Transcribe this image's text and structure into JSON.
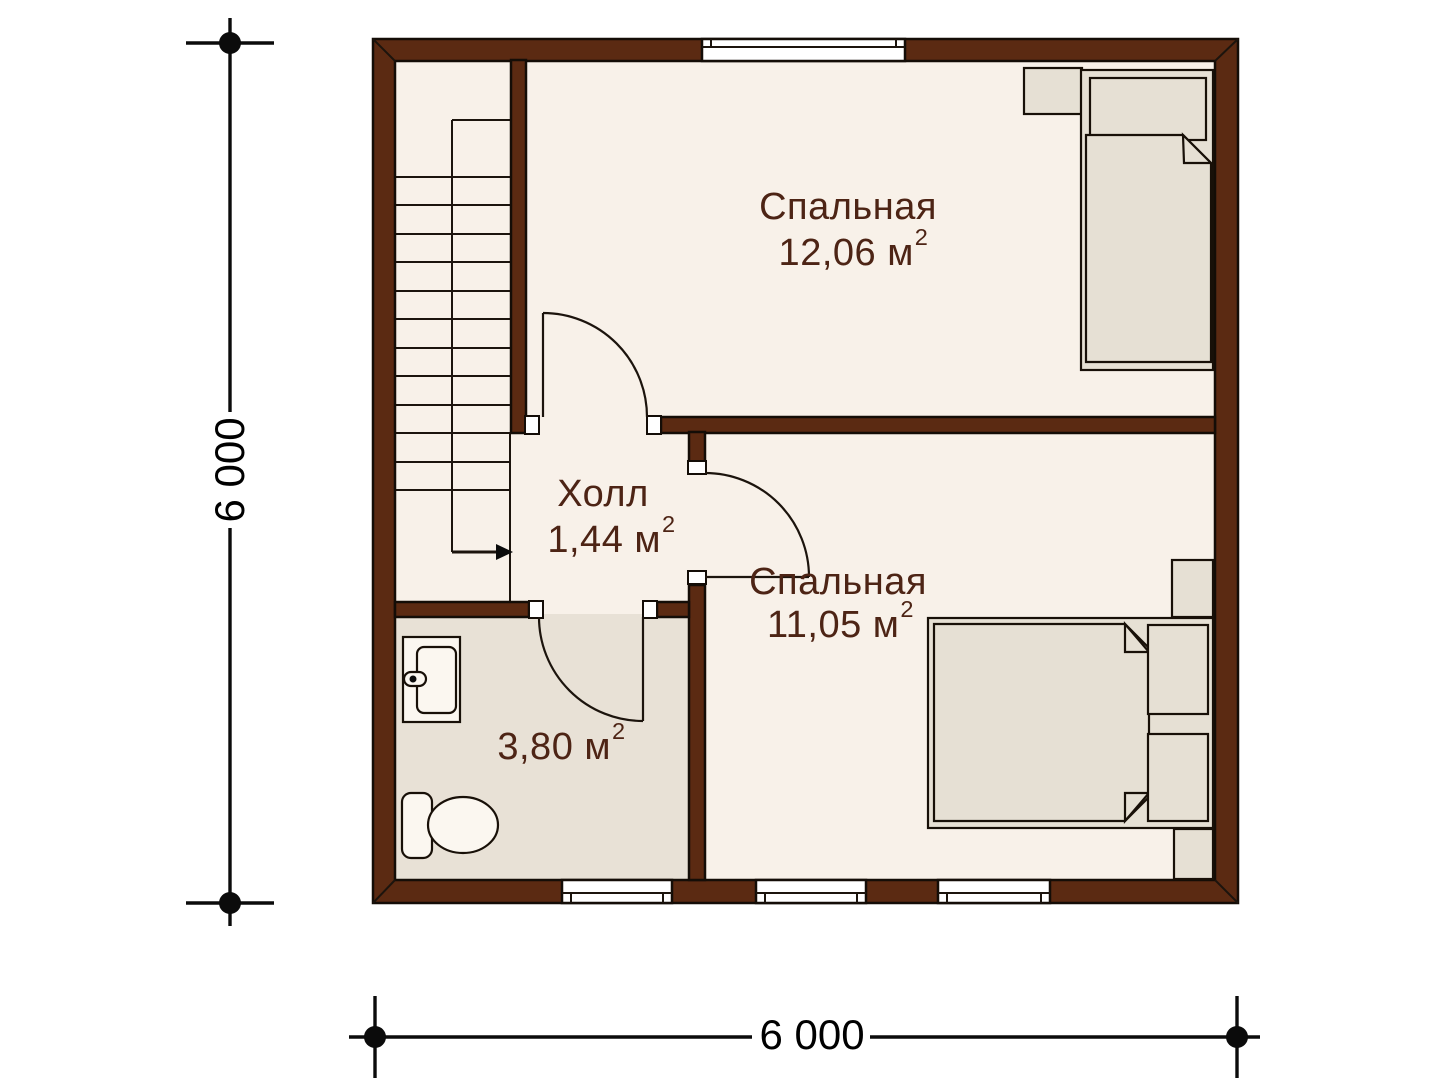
{
  "page": {
    "background": "#ffffff"
  },
  "colors": {
    "wall": "#5B2A12",
    "outline": "#140D07",
    "floor": "#F8F1E9",
    "wet-floor": "#E8E1D6",
    "furniture": "#E6E0D4",
    "fixture": "#FBF7F0",
    "window": "#FFFFFF",
    "label": "#4D2415",
    "dimension": "#0B0B0B"
  },
  "rooms": [
    {
      "name": "Спальная",
      "area": "12,06 м",
      "area_sup": "2"
    },
    {
      "name": "Холл",
      "area": "1,44 м",
      "area_sup": "2"
    },
    {
      "name": "Спальная",
      "area": "11,05 м",
      "area_sup": "2"
    },
    {
      "name": "",
      "area": "3,80 м",
      "area_sup": "2"
    }
  ],
  "dimensions": {
    "left": "6 000",
    "bottom": "6 000"
  }
}
